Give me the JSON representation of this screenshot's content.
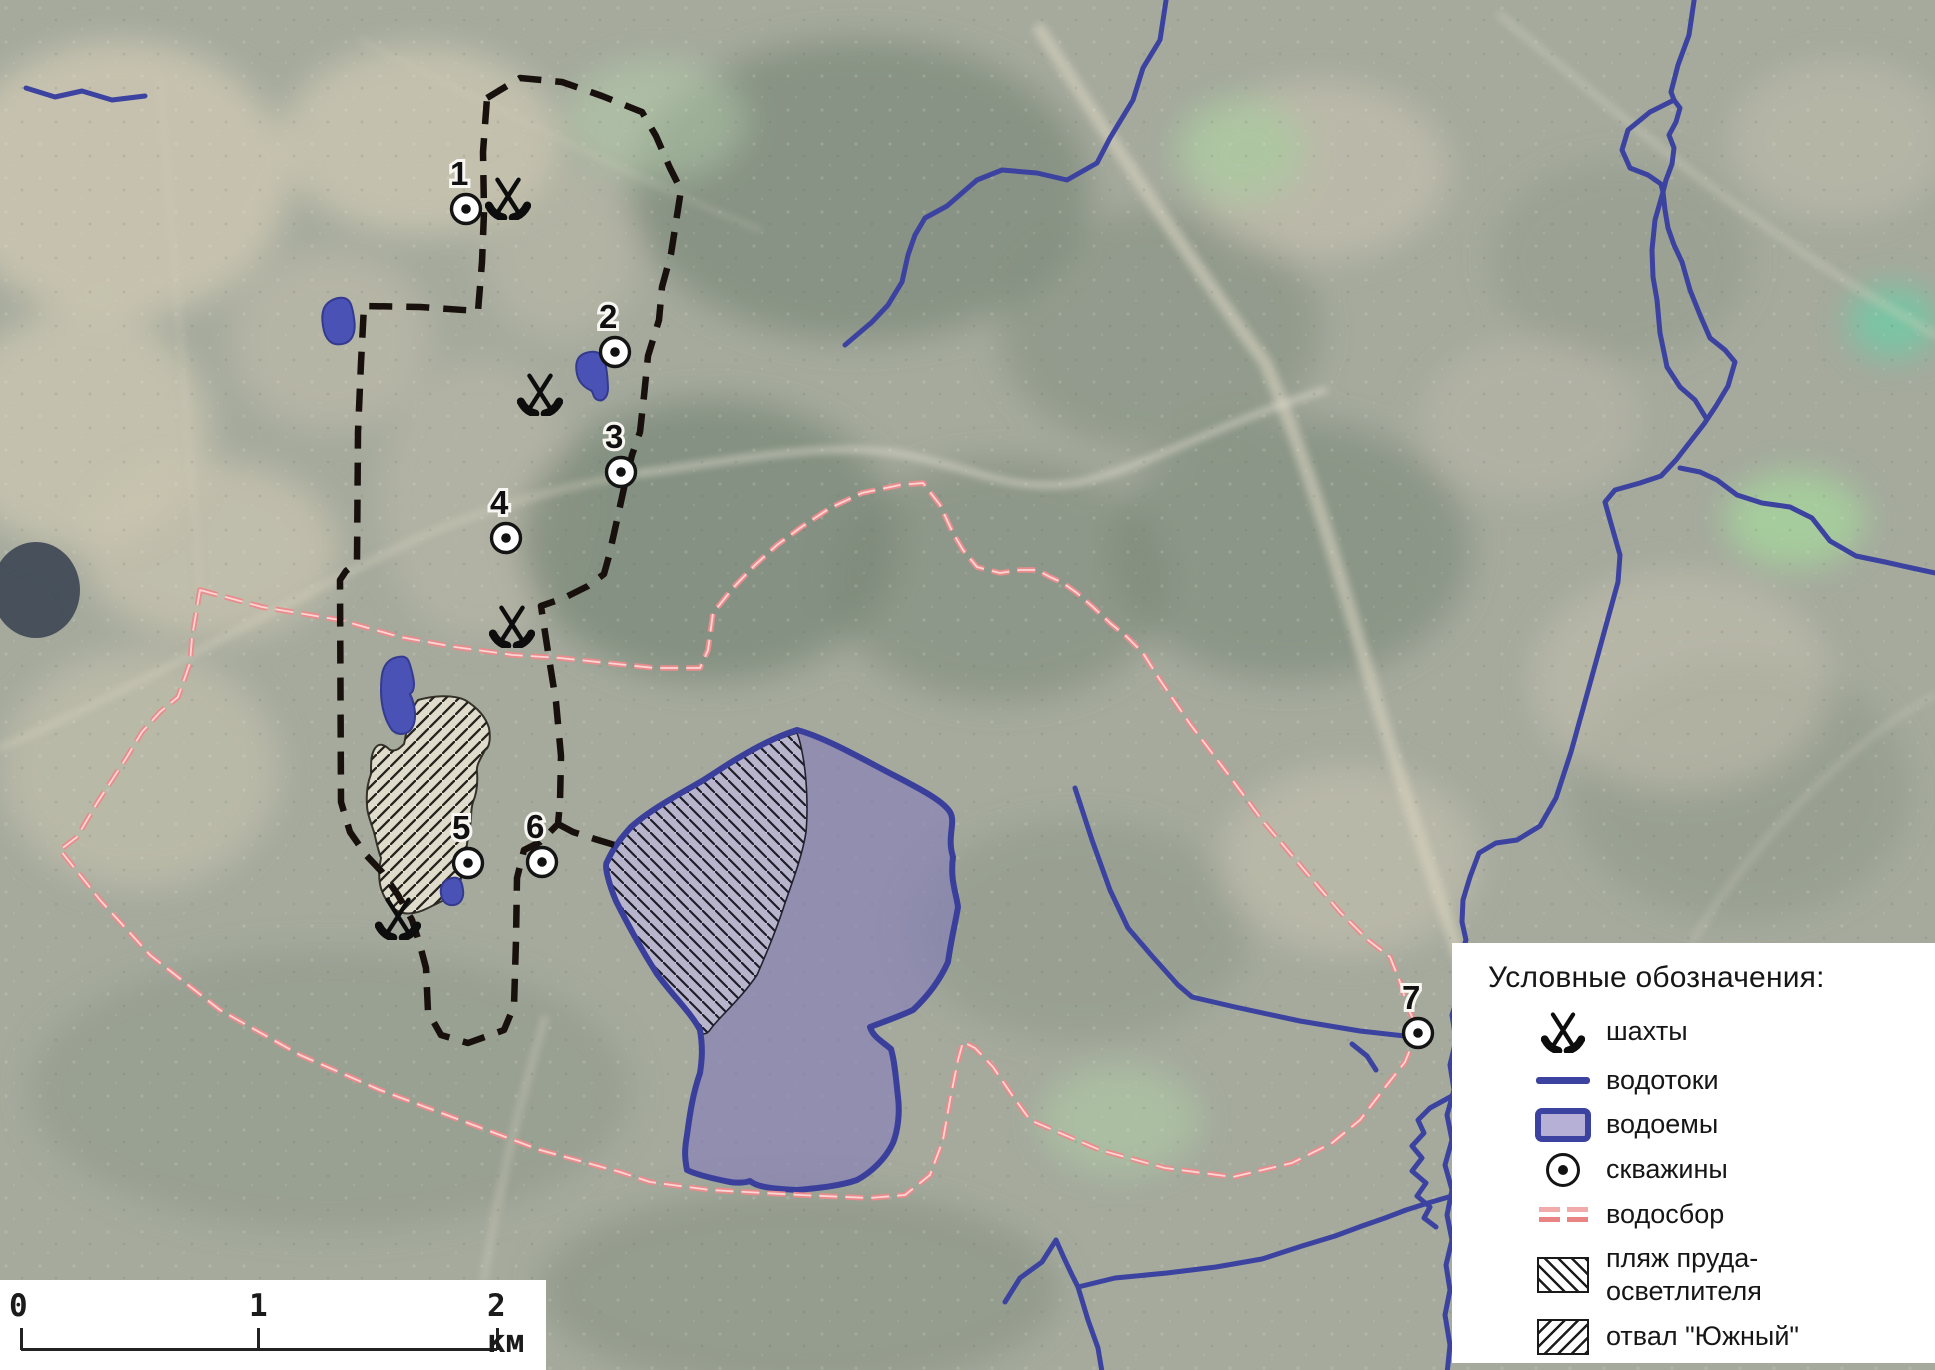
{
  "legend": {
    "title": "Условные обозначения:",
    "items": [
      {
        "icon": "mine-icon",
        "label": "шахты"
      },
      {
        "icon": "watercourse-icon",
        "label": "водотоки"
      },
      {
        "icon": "waterbody-icon",
        "label": "водоемы"
      },
      {
        "icon": "well-icon",
        "label": "скважины"
      },
      {
        "icon": "watershed-icon",
        "label": "водосбор"
      },
      {
        "icon": "beach-hatch-icon",
        "label": "пляж пруда-\nосветлителя"
      },
      {
        "icon": "dump-hatch-icon",
        "label": "отвал \"Южный\""
      }
    ]
  },
  "scalebar": {
    "ticks": [
      {
        "label": "0",
        "x": 21
      },
      {
        "label": "1",
        "x": 258
      },
      {
        "label": "2 км",
        "x": 497
      }
    ]
  },
  "map": {
    "colors": {
      "water": "#3c42a0",
      "pond_fill": "rgba(132,125,188,0.62)",
      "pond_stroke": "#3b3f9c",
      "watershed": "#ea8c8c",
      "boundary": "#18100c",
      "dump_fill": "rgba(238,233,216,0.8)",
      "beach_fill": "rgba(232,229,240,0.45)"
    },
    "wells": [
      {
        "n": "1",
        "x": 466,
        "y": 209
      },
      {
        "n": "2",
        "x": 615,
        "y": 352
      },
      {
        "n": "3",
        "x": 621,
        "y": 472
      },
      {
        "n": "4",
        "x": 506,
        "y": 538
      },
      {
        "n": "5",
        "x": 468,
        "y": 863
      },
      {
        "n": "6",
        "x": 542,
        "y": 862
      },
      {
        "n": "7",
        "x": 1418,
        "y": 1033
      }
    ],
    "mines": [
      {
        "x": 508,
        "y": 197
      },
      {
        "x": 540,
        "y": 393
      },
      {
        "x": 512,
        "y": 625
      },
      {
        "x": 398,
        "y": 917
      }
    ],
    "features": {
      "rivers": [
        "M1695,-6 L1689,35 1678,65 1671,92 1674,100 1680,108 1676,122 1669,135 1674,148 1672,164 1666,180 1663,192 1665,210 1668,228 1674,245 1682,262 1690,290 1700,315 1710,338 1725,350 1735,362 1728,386 1716,406 1704,424 1690,442 1676,460 1661,476 1640,483 1615,490 1605,502 1610,520 1620,555 1618,582 1602,640 1586,698 1571,752 1556,798 1540,826 1517,840 1496,843 1479,853 1470,877 1463,900 1462,922 1466,940 1458,965 1460,990 1452,1015 1456,1040 1450,1065 1454,1090 1447,1115 1452,1140 1445,1165 1452,1190 1447,1215 1452,1240 1446,1265 1450,1290 1445,1315 1450,1345 1447,1374",
        "M1674,100 L1650,112 1628,130 1622,150 1630,168 1648,175 1661,184 1663,192",
        "M1663,192 L1655,220 1652,250 1653,277 1657,300 1660,333 1667,367 1680,387 1695,400 1706,418",
        "M1680,468 L1700,472 1717,480 1737,495 1762,503 1790,507 1812,518 1830,541 1856,556 1885,562 1912,568 1940,574",
        "M1167,-6 L1160,40 1143,68 1133,100 1110,138 1097,163 1067,180 1037,173 1002,170 977,180 947,206 925,218 915,235 908,255 902,282 888,305 872,322 845,345",
        "M26,88 L55,97 82,91 112,100 145,96",
        "M1075,788 L1092,840 1110,890 1128,928 1152,956 1178,985 1192,997 1235,1007 1300,1021 1360,1031 1405,1036",
        "M1352,1044 L1367,1056 1376,1070",
        "M1005,1302 L1020,1278 1042,1262 1056,1240 1064,1258 1072,1275 1078,1287 1115,1278 1167,1273 1216,1267 1262,1259 1302,1246 1335,1236 1362,1226 1385,1218 1406,1210 1428,1203 1452,1196",
        "M1078,1287 L1088,1320 1098,1348 1102,1372",
        "M1452,1096 L1430,1108 1418,1120 1424,1133 1412,1146 1422,1158 1412,1171 1426,1183 1417,1196 1430,1207 1424,1218 1436,1227"
      ],
      "watershed": "M200,590 L262,607 340,620 400,637 455,647 513,655 560,658 607,663 655,668 700,668 708,650 713,613 733,588 755,565 777,545 800,528 830,508 862,493 900,485 923,483 940,505 953,533 963,550 977,567 1000,573 1020,570 1037,570 1050,577 1063,583 1077,593 1093,607 1110,623 1127,637 1143,653 1160,680 1190,724 1225,770 1262,820 1300,865 1340,912 1368,940 1390,957 1400,982 1408,1008 1418,1030 1405,1062 1383,1090 1360,1120 1332,1143 1292,1163 1233,1177 1165,1168 1100,1150 1060,1133 1030,1120 1012,1095 993,1067 975,1048 963,1042 958,1060 950,1100 943,1140 930,1175 905,1195 870,1198 800,1195 710,1190 650,1182 620,1172 540,1150 460,1120 380,1090 300,1055 220,1010 150,955 100,900 60,850 77,837 97,803 125,760 142,732 160,712 178,697 190,663 192,637 Z",
      "boundary": "M487,98 L520,78 562,82 602,96 642,112 656,136 670,168 681,190 676,222 671,254 662,287 659,320 648,356 644,396 640,432 632,455 624,488 617,520 609,556 604,574 588,586 564,598 541,606 548,652 556,702 561,756 560,802 558,824 540,842 524,850 517,878 516,940 514,1006 504,1030 468,1043 441,1035 428,1012 426,968 420,945 412,920 398,895 382,872 366,855 350,832 341,802 340,580 346,571 357,562 358,432 361,363 364,306 420,307 478,311 482,262 484,212 483,152 Z",
      "boundary_spur": "M558,824 L573,832 598,840 618,846",
      "pond": "M797,730 C820,736 850,752 880,768 C910,784 945,800 951,814 C955,824 947,838 953,857 C950,880 956,892 958,907 C955,925 951,940 948,962 C940,980 928,996 913,1010 C898,1017 883,1022 870,1027 C873,1037 883,1042 891,1049 C895,1063 896,1080 898,1097 C900,1113 898,1130 893,1143 C885,1160 870,1173 857,1180 C840,1186 818,1188 797,1190 C778,1189 758,1188 750,1181 C745,1183 735,1183 730,1182 C715,1179 697,1175 687,1170 C684,1155 685,1147 687,1135 C690,1113 693,1093 700,1073 C702,1060 703,1048 700,1030 C692,1014 673,996 657,974 C643,952 628,925 616,901 C608,882 604,864 607,862 C614,846 623,836 631,827 C650,810 676,796 702,781 C715,773 726,765 740,757 C760,745 778,736 797,730 Z",
      "beach": "M797,733 C780,738 760,746 740,757 C726,765 715,773 702,781 C676,796 650,810 631,827 C623,836 614,846 607,862 C604,864 608,882 616,901 C628,925 643,952 657,974 C673,996 692,1014 700,1030 C702,1036 707,1034 710,1030 C718,1018 740,1000 757,975 C768,950 778,925 785,903 C795,875 803,852 806,832 C808,810 807,780 803,757 C801,745 799,738 797,733 Z",
      "dump": "M418,700 C432,696 452,694 465,700 C478,708 486,718 489,728 C491,740 489,748 485,750 C480,760 476,765 477,772 C478,785 476,795 473,802 C470,812 472,818 470,826 C467,840 466,850 466,860 C464,872 460,882 456,890 C448,900 437,903 428,908 C416,914 405,916 396,910 C387,903 382,895 380,884 C378,872 380,864 381,858 C378,850 376,840 374,832 C370,820 367,812 367,805 C366,792 368,782 371,774 C371,762 371,756 374,750 C378,742 384,744 390,750 C396,752 400,748 404,744 C406,736 406,730 409,722 C411,712 414,705 418,700 Z",
      "small_ponds": [
        "M338,298 C322,302 321,314 323,326 C325,340 332,346 342,344 C354,342 356,330 354,318 C352,304 350,296 338,298 Z",
        "M590,352 C576,354 575,364 577,374 C579,384 586,388 590,390 C594,391 592,396 596,399 C602,403 608,398 608,388 C607,362 604,350 590,352 Z",
        "M398,657 C381,660 381,678 381,690 C381,708 386,722 392,730 C398,736 408,735 412,728 C418,718 414,702 410,694 C416,690 414,680 412,672 C409,660 408,655 398,657 Z",
        "M452,878 C442,880 440,888 441,894 C442,902 447,906 454,905 C461,904 464,897 463,890 C462,882 460,876 452,878 Z"
      ]
    }
  }
}
